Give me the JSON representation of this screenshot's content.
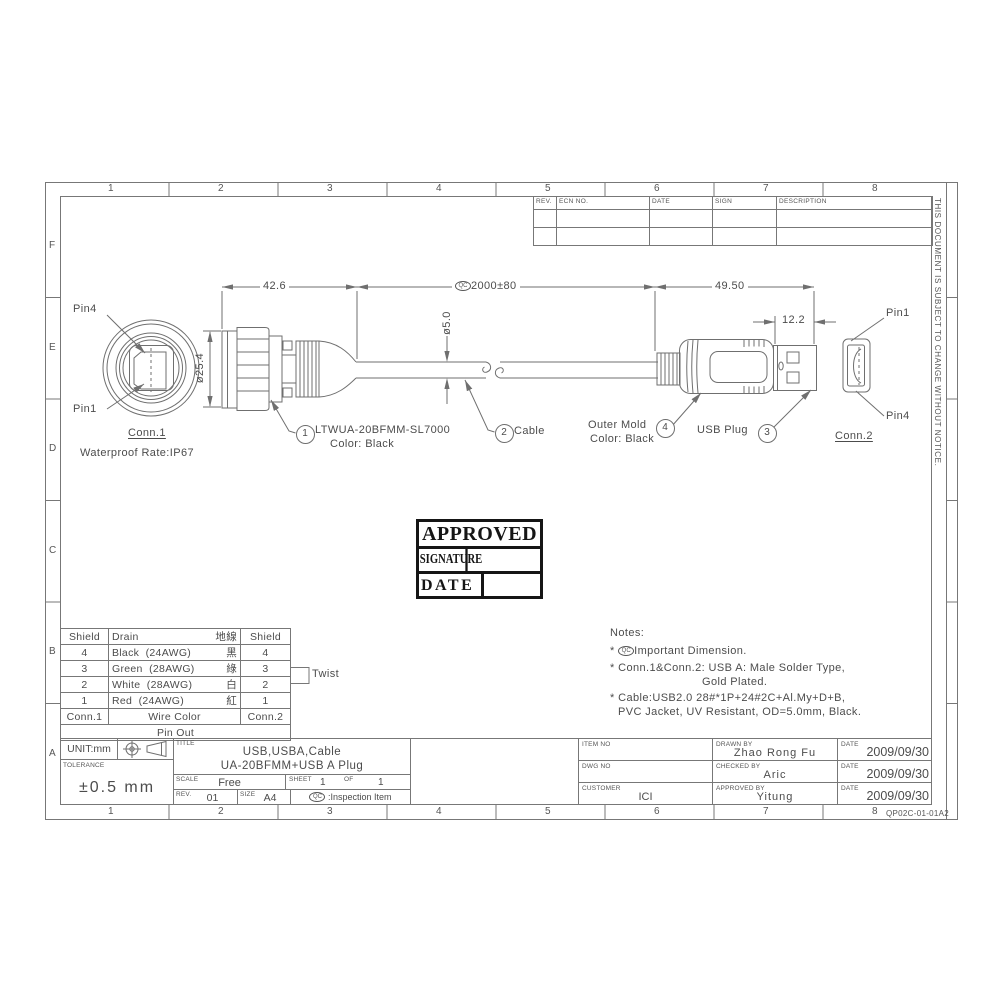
{
  "page": {
    "grid_cols": [
      "1",
      "2",
      "3",
      "4",
      "5",
      "6",
      "7",
      "8"
    ],
    "grid_rows": [
      "F",
      "E",
      "D",
      "C",
      "B",
      "A"
    ],
    "side_note": "THIS DOCUMENT IS SUBJECT TO CHANGE WITHOUT NOTICE.",
    "sheet_code": "QP02C-01-01A2",
    "qc_symbol": "QC"
  },
  "rev_table": {
    "headers": [
      "REV.",
      "ECN NO.",
      "DATE",
      "SIGN",
      "DESCRIPTION"
    ]
  },
  "drawing": {
    "dim_42": "42.6",
    "dim_2000": "2000±80",
    "dim_49": "49.50",
    "dim_12": "12.2",
    "dim_d5": "ø5.0",
    "dim_d25": "ø25.4",
    "pin1": "Pin1",
    "pin4": "Pin4",
    "conn1_name": "Conn.1",
    "conn1_rate": "Waterproof Rate:IP67",
    "conn2_name": "Conn.2",
    "callout1_num": "1",
    "callout1_line1": "LTWUA-20BFMM-SL7000",
    "callout1_line2": "Color: Black",
    "callout2_num": "2",
    "callout2_label": "Cable",
    "callout3_num": "3",
    "callout3_label": "USB Plug",
    "callout4_num": "4",
    "callout4_line1": "Outer Mold",
    "callout4_line2": "Color: Black"
  },
  "stamp": {
    "approved": "APPROVED",
    "signature": "SIGNATURE",
    "date": "DATE"
  },
  "pinout": {
    "header_shield": "Shield",
    "header_drain": "Drain",
    "header_cn": "地線",
    "rows": [
      {
        "l": "4",
        "wire": "Black",
        "awg": "(24AWG)",
        "cn": "黑",
        "r": "4"
      },
      {
        "l": "3",
        "wire": "Green",
        "awg": "(28AWG)",
        "cn": "綠",
        "r": "3"
      },
      {
        "l": "2",
        "wire": "White",
        "awg": "(28AWG)",
        "cn": "白",
        "r": "2"
      },
      {
        "l": "1",
        "wire": "Red",
        "awg": "(24AWG)",
        "cn": "紅",
        "r": "1"
      }
    ],
    "footer_conn1": "Conn.1",
    "footer_mid": "Wire Color",
    "footer_conn2": "Conn.2",
    "footer2": "Pin Out",
    "twist": "Twist"
  },
  "notes": {
    "title": "Notes:",
    "bullet": "*",
    "n1": "Important Dimension.",
    "n2a": "Conn.1&Conn.2: USB A: Male Solder Type,",
    "n2b": "Gold Plated.",
    "n3a": "Cable:USB2.0 28#*1P+24#2C+Al.My+D+B,",
    "n3b": "PVC Jacket, UV Resistant, OD=5.0mm, Black."
  },
  "titleblock": {
    "unit": "UNIT:mm",
    "tolerance_label": "TOLERANCE",
    "tolerance": "±0.5 mm",
    "title_label": "TITLE",
    "title1": "USB,USBA,Cable",
    "title2": "UA-20BFMM+USB A Plug",
    "scale_label": "SCALE",
    "scale": "Free",
    "sheet_label": "SHEET",
    "sheet": "1",
    "of_label": "OF",
    "of": "1",
    "rev_label": "REV.",
    "rev": "01",
    "size_label": "SIZE",
    "size": "A4",
    "inspection": ":Inspection Item",
    "item_no_label": "ITEM NO",
    "dwg_no_label": "DWG NO",
    "customer_label": "CUSTOMER",
    "customer": "ICI",
    "drawn_label": "DRAWN BY",
    "drawn": "Zhao Rong Fu",
    "checked_label": "CHECKED BY",
    "checked": "Aric",
    "approved_label": "APPROVED BY",
    "approved": "Yitung",
    "date_label": "DATE",
    "date1": "2009/09/30",
    "date2": "2009/09/30",
    "date3": "2009/09/30"
  }
}
